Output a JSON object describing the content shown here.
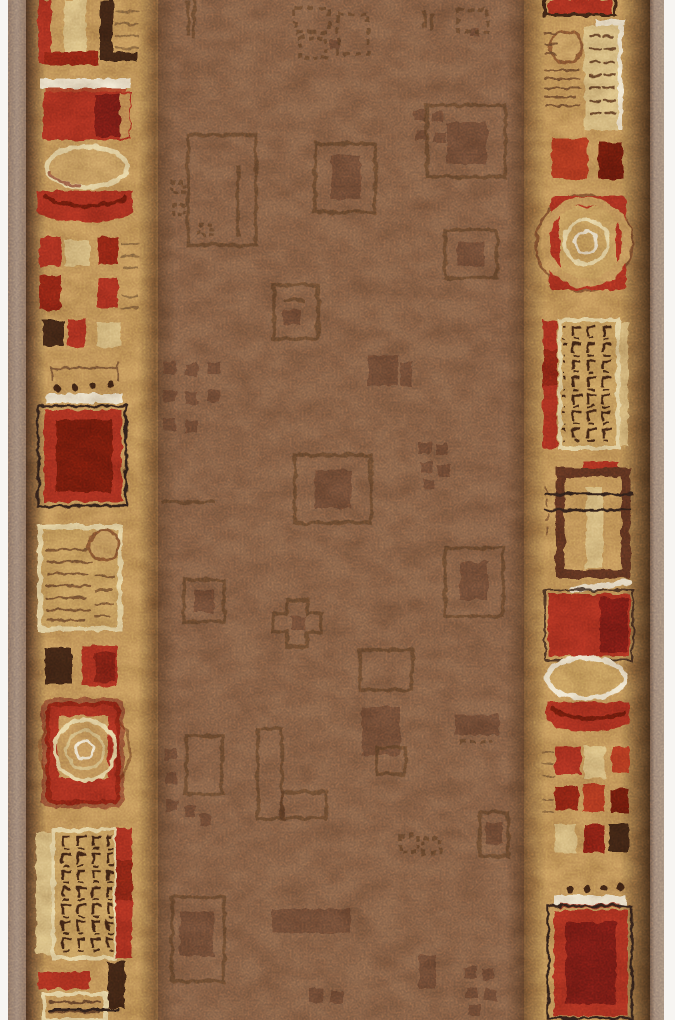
{
  "image": {
    "type": "product-photograph",
    "subject": "vertical carpet runner rug, cropped at top and bottom",
    "description": "brown mottled center field with tone-on-tone square motifs; beige side borders with abstract red, cream and dark-brown geometric ornaments; taupe fabric binding on both long edges; white studio background slivers at left and right"
  },
  "palette": {
    "bg_white": "#f7f5f2",
    "binding_taupe": "#9d8779",
    "binding_shadow": "#6e5a4c",
    "edge_dark": "#4a3222",
    "blend_brown": "#5d4028",
    "border_tan": "#c69a5e",
    "field_brown": "#86634a",
    "field_motif": "#573823",
    "grid_tan": "#c9a162",
    "tan_circle": "#cba266",
    "ring_brown": "#8a5a34",
    "ring_dark": "#6b3a22",
    "red": "#ad3320",
    "red_bright": "#b43a22",
    "red_deep": "#922817",
    "red_darker": "#8a2015",
    "maroon": "#6f1a10",
    "dark_brown": "#3f2617",
    "frame_brown": "#5e3520",
    "cream": "#e8d7a8",
    "cream_bright": "#f0e7d2",
    "cream_dim": "#d9c28c",
    "khaki": "#dcc288",
    "sketch_black": "#33231a",
    "sketch_brown": "#6b4a2e",
    "tan_stripe": "#8a6a42"
  },
  "rug": {
    "orientation": "vertical runner",
    "field": {
      "base_color_ref": "field_brown",
      "motif_color_ref": "field_motif",
      "motif_types": [
        "nested-squares",
        "outline-squares",
        "pixel-clusters",
        "l-shapes",
        "plus-cross",
        "dark-bars",
        "dotted-squares"
      ]
    },
    "left_border": {
      "dot_count": 4,
      "motifs_top_to_bottom": [
        "striped-frame-with-red-cream-brown-bars",
        "white-highlight-line",
        "red-panel-with-maroon-center",
        "cream-outlined-oval",
        "red-arc-bowl",
        "grid-of-small-red-cream-brown-squares",
        "sketched-outline-lines",
        "four-dots",
        "white-highlight-line",
        "sketch-framed-red-panel",
        "cream-outlined-striped-card-with-tan-circle",
        "brown-and-red-square-pair",
        "target-rings-on-red-square",
        "waffle-grid-card-with-cream-and-red-bars",
        "partial-red-bar-and-striped-card"
      ]
    },
    "right_border": {
      "dot_count": 4,
      "motifs_top_to_bottom": [
        "partial-red-panel",
        "striped-card-with-tan-circle",
        "red-and-maroon-square-pair",
        "target-rings-in-red-frame",
        "waffle-grid-card-with-red-bar",
        "sketch-lined-frame-with-tan-bar",
        "red-panel-with-white-highlight",
        "cream-outlined-oval",
        "red-arc-bowl",
        "grid-of-small-red-cream-brown-squares",
        "four-dots",
        "white-highlight-line",
        "sketch-framed-red-panel"
      ]
    },
    "bindings": "narrow taupe fabric edge on both long sides"
  }
}
